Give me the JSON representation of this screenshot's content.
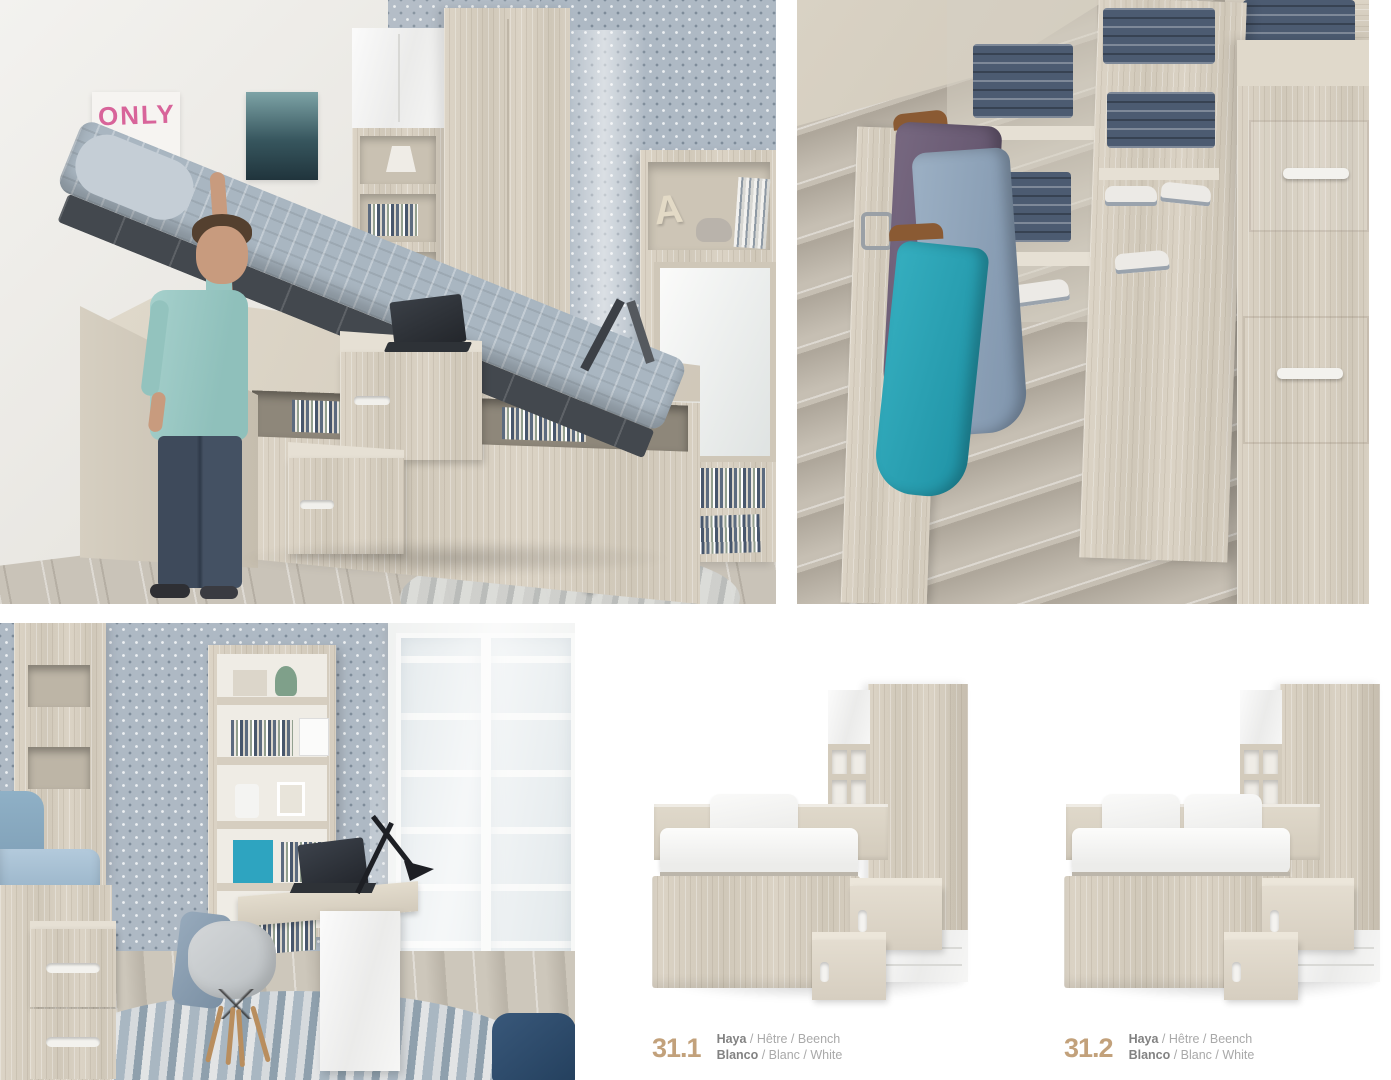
{
  "palette": {
    "accent_tan": "#c2a17b",
    "caption_bold_gray": "#828282",
    "caption_light_gray": "#a9a9a9",
    "beech_wood": "#d7cfc1",
    "wallpaper_blue": "#aeb9c4",
    "mattress_blue_gray": "#a9b6c1",
    "teal_jacket": "#2aa3b5",
    "plum_jacket": "#6e5f78",
    "denim_blue": "#4c5b71"
  },
  "scenes": {
    "top_left": {
      "description": "teen lifting mattress of lift-up storage bed",
      "poster_text": "ONLY",
      "shelf_letter": "A"
    },
    "top_right": {
      "description": "open under-bed storage with hanging jackets, folded jeans, shoes and drawers"
    },
    "bottom_left": {
      "description": "fold-out desk with bookshelf, chair, lamp and bed steps"
    }
  },
  "products": {
    "items": [
      {
        "code": "31.1",
        "wood_primary": "Haya",
        "wood_rest": " / Hêtre / Beench",
        "color_primary": "Blanco",
        "color_rest": " / Blanc / White"
      },
      {
        "code": "31.2",
        "wood_primary": "Haya",
        "wood_rest": " / Hêtre / Beench",
        "color_primary": "Blanco",
        "color_rest": " / Blanc / White"
      }
    ]
  }
}
